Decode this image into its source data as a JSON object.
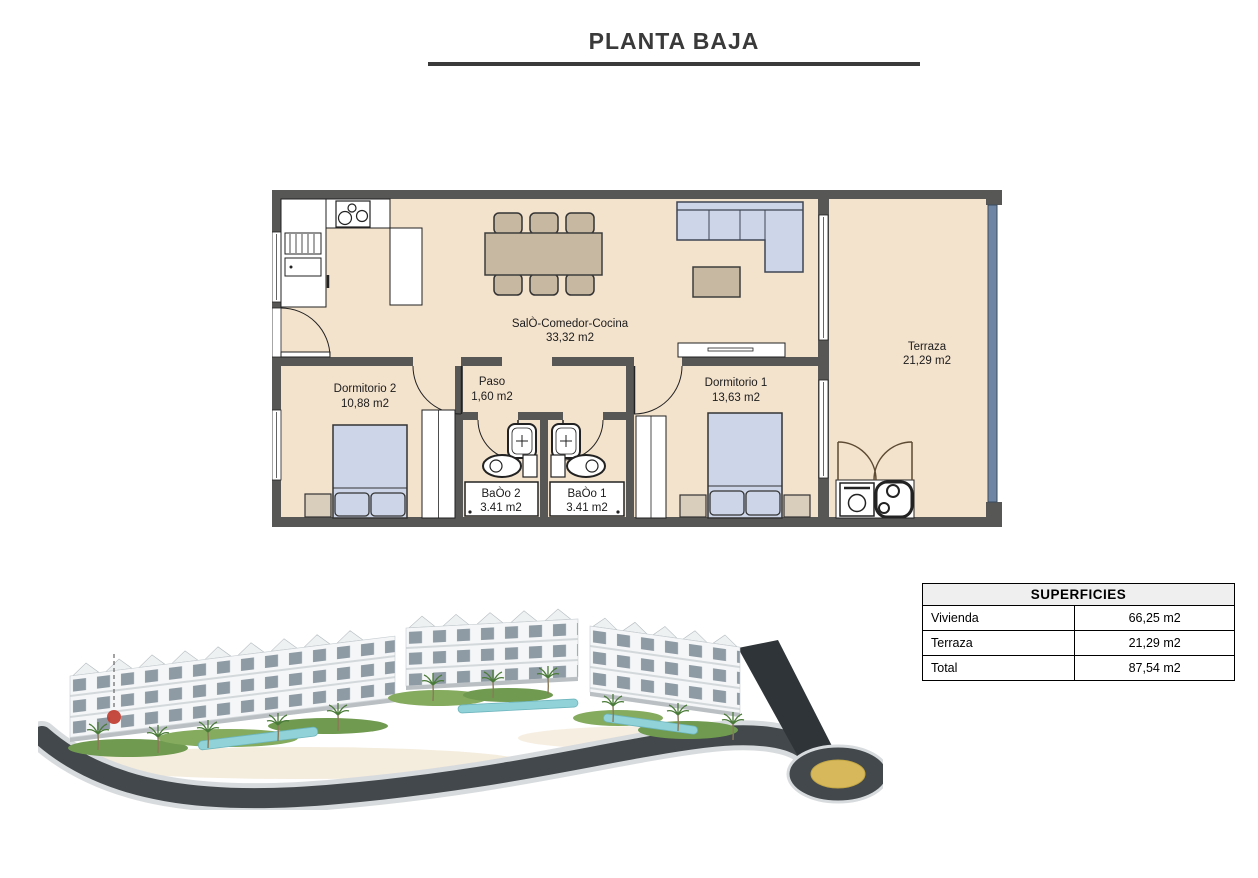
{
  "page": {
    "title": "PLANTA BAJA"
  },
  "floor_plan": {
    "rooms": [
      {
        "name": "SalÒ-Comedor-Cocina",
        "area": "33,32 m2"
      },
      {
        "name": "Terraza",
        "area": "21,29 m2"
      },
      {
        "name": "Dormitorio 2",
        "area": "10,88 m2"
      },
      {
        "name": "Paso",
        "area": "1,60 m2"
      },
      {
        "name": "Dormitorio 1",
        "area": "13,63 m2"
      },
      {
        "name": "BaÒo 2",
        "area": "3.41 m2"
      },
      {
        "name": "BaÒo 1",
        "area": "3.41 m2"
      }
    ],
    "colors": {
      "floor": "#f3e2cc",
      "wall": "#575756",
      "furniture_blue": "#cdd6e8",
      "furniture_tan": "#c7b8a1",
      "bedside_tan": "#d9cdbb",
      "railing_blue": "#6e86a4",
      "title_gray": "#3a3a3a"
    }
  },
  "surfaces_table": {
    "title": "SUPERFICIES",
    "rows": [
      {
        "label": "Vivienda",
        "value": "66,25 m2"
      },
      {
        "label": "Terraza",
        "value": "21,29 m2"
      },
      {
        "label": "Total",
        "value": "87,54 m2"
      }
    ]
  },
  "site_render": {
    "marker_color": "#c0392b",
    "road_color": "#42484c",
    "pool_color": "#90d2d8",
    "grass_color": "#6f9a4f",
    "roundabout_color": "#d7b95b"
  }
}
